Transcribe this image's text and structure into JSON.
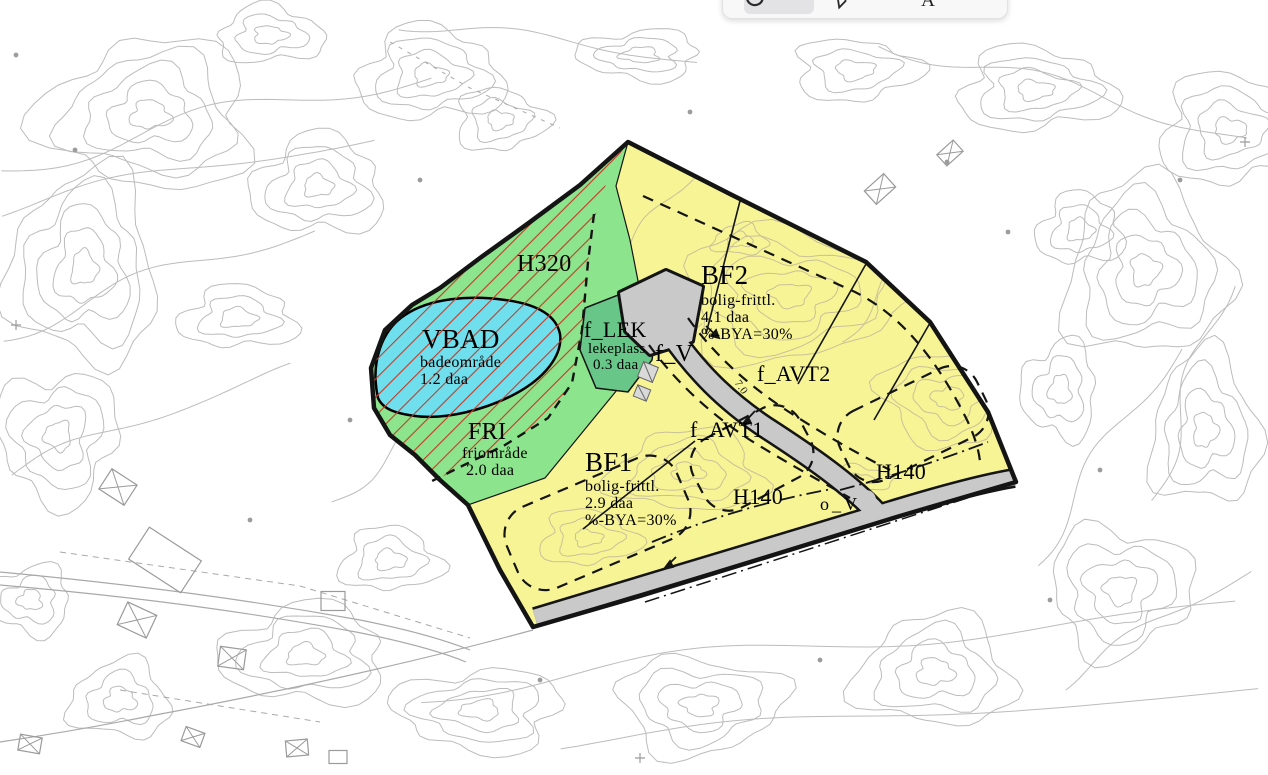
{
  "toolbar": {
    "buttons": [
      {
        "name": "lasso-selection",
        "selected": true
      },
      {
        "name": "pen",
        "selected": false
      },
      {
        "name": "text",
        "selected": false
      }
    ]
  },
  "map": {
    "areas": {
      "vbad": {
        "code": "VBAD",
        "desc": "badeområde",
        "size": "1.2 daa"
      },
      "fri": {
        "code": "FRI",
        "desc": "friområde",
        "size": "2.0 daa"
      },
      "f_lek": {
        "code": "f_LEK",
        "desc": "lekeplass",
        "size": "0.3 daa"
      },
      "bf1": {
        "code": "BF1",
        "desc": "bolig-frittl.",
        "size": "2.9 daa",
        "bya": "%-BYA=30%"
      },
      "bf2": {
        "code": "BF2",
        "desc": "bolig-frittl.",
        "size": "4.1 daa",
        "bya": "%-BYA=30%"
      }
    },
    "zones": {
      "h320": "H320",
      "h140_west": "H140",
      "h140_east": "H140"
    },
    "roads": {
      "f_v": "f_V",
      "o_v": "o_V",
      "f_avt1": "f_AVT1",
      "f_avt2": "f_AVT2",
      "width_label": "7.0"
    },
    "colors": {
      "residential_yellow": "#f7f496",
      "green_open": "#8ce48c",
      "playground_green": "#67c688",
      "bathing_cyan": "#6fdfee",
      "road_gray": "#c9c9c9",
      "hazard_red": "#c73925",
      "boundary_black": "#141414",
      "contour_gray": "#bcbcbc",
      "contour_tan": "#c9c098"
    }
  }
}
